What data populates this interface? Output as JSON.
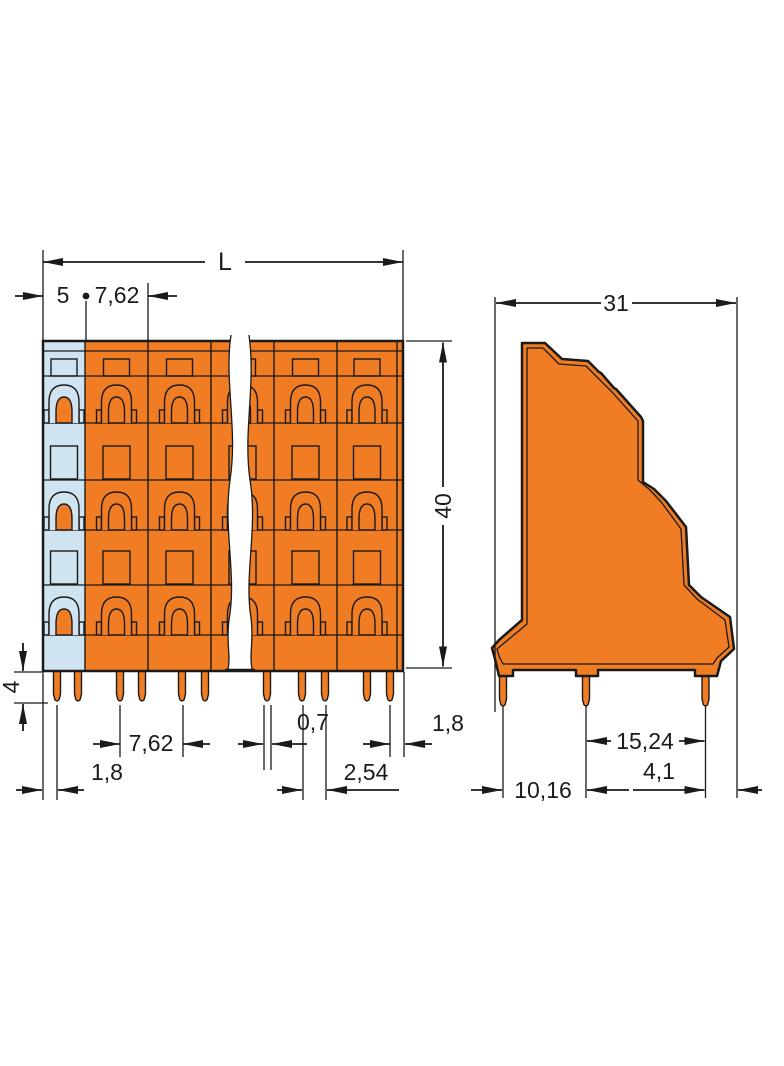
{
  "drawing_type": "dimensional-drawing",
  "colors": {
    "housing_orange": "#f07d23",
    "first_pole_blue": "#cfe3f0",
    "line_black": "#1a1a1a",
    "background": "#ffffff"
  },
  "front_view": {
    "overall_length": "L",
    "first_pole_width": "5",
    "pole_pitch": "7,62",
    "height": "40",
    "pin_length": "4",
    "pin_pitch": "7,62",
    "pin_width": "0,7",
    "right_edge_to_pin": "1,8",
    "left_edge_to_pin": "1,8",
    "pin_pair_spacing": "2,54"
  },
  "side_view": {
    "depth": "31",
    "outer_pin_spacing": "15,24",
    "pin_to_edge": "4,1",
    "inner_pin_spacing": "10,16"
  }
}
